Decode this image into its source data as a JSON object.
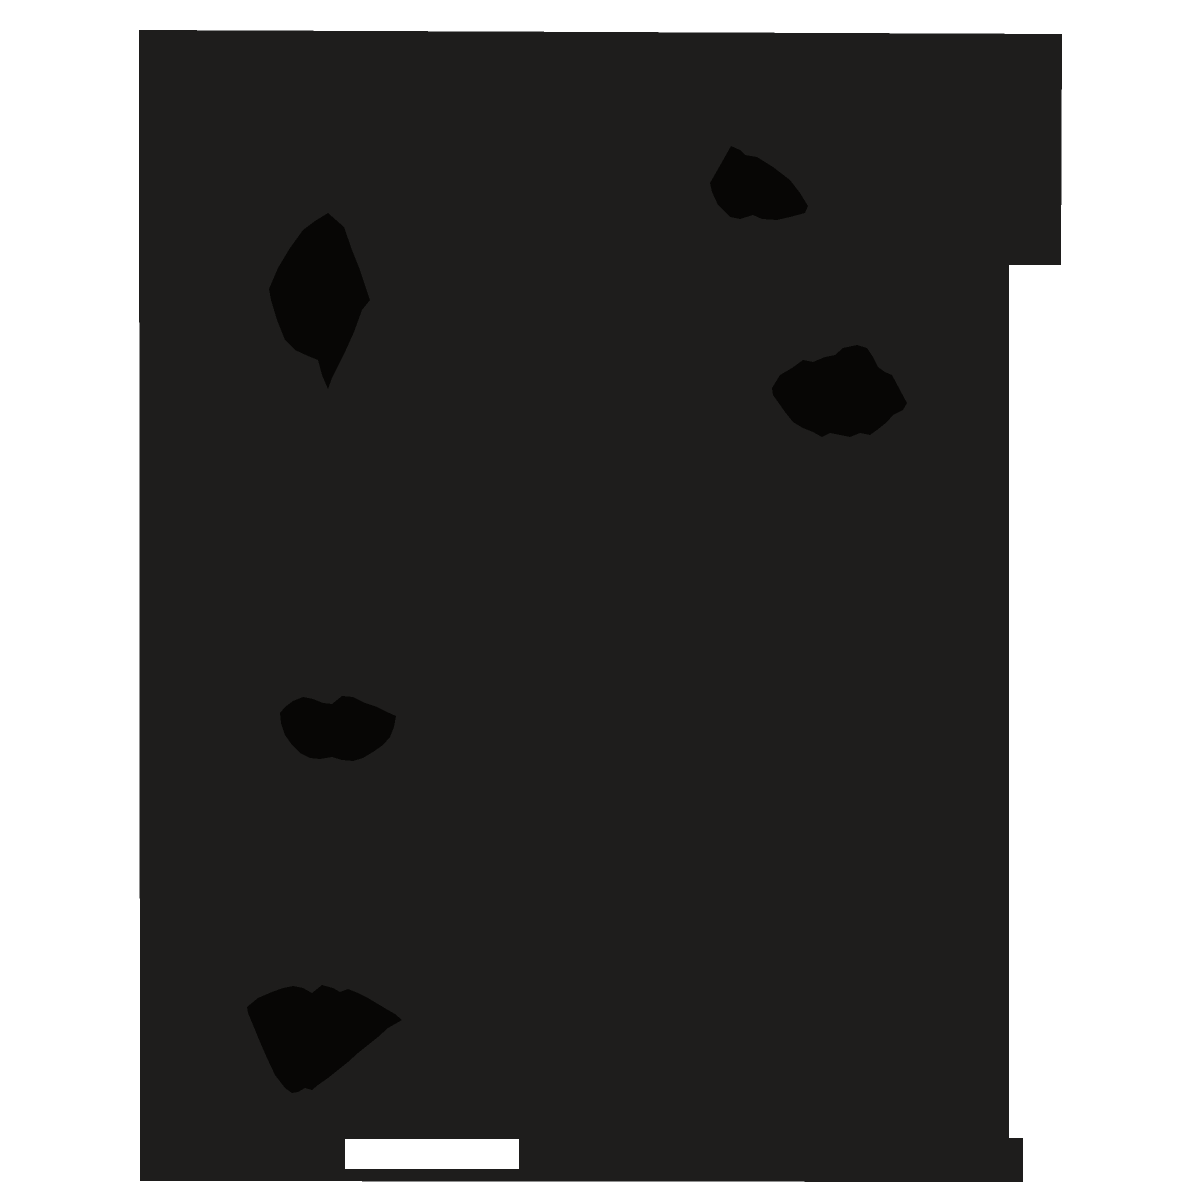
{
  "scene": {
    "description": "Scan of an almost entirely black page on a white backdrop; the dark page has slightly irregular stepped edges, five solid black ink blots, and one small white rectangular cutout near the bottom left",
    "colors": {
      "backdrop_white": "#ffffff",
      "page_dark": "#1e1d1c",
      "ink_black": "#070605"
    },
    "page_region": {
      "name": "dark-page-region",
      "points": [
        [
          139,
          30
        ],
        [
          1062,
          34
        ],
        [
          1061,
          265
        ],
        [
          1009,
          265
        ],
        [
          1009,
          1138
        ],
        [
          1023,
          1138
        ],
        [
          1023,
          1182
        ],
        [
          140,
          1181
        ]
      ]
    },
    "cutout": {
      "name": "white-cutout-rect",
      "x": 345,
      "y": 1139,
      "width": 174,
      "height": 30,
      "color": "#ffffff"
    },
    "blots": [
      {
        "name": "ink-blot-upper-left-diamond",
        "points": [
          [
            328,
            213
          ],
          [
            344,
            227
          ],
          [
            352,
            250
          ],
          [
            360,
            270
          ],
          [
            370,
            300
          ],
          [
            362,
            310
          ],
          [
            354,
            332
          ],
          [
            345,
            352
          ],
          [
            337,
            368
          ],
          [
            332,
            378
          ],
          [
            328,
            389
          ],
          [
            322,
            375
          ],
          [
            318,
            360
          ],
          [
            308,
            356
          ],
          [
            295,
            350
          ],
          [
            285,
            340
          ],
          [
            277,
            320
          ],
          [
            271,
            300
          ],
          [
            269,
            289
          ],
          [
            278,
            268
          ],
          [
            290,
            248
          ],
          [
            303,
            230
          ],
          [
            315,
            221
          ]
        ]
      },
      {
        "name": "ink-blot-top-right",
        "points": [
          [
            710,
            183
          ],
          [
            722,
            162
          ],
          [
            731,
            146
          ],
          [
            740,
            150
          ],
          [
            745,
            155
          ],
          [
            757,
            157
          ],
          [
            773,
            167
          ],
          [
            790,
            180
          ],
          [
            800,
            193
          ],
          [
            808,
            206
          ],
          [
            805,
            213
          ],
          [
            790,
            217
          ],
          [
            777,
            220
          ],
          [
            762,
            219
          ],
          [
            753,
            215
          ],
          [
            740,
            219
          ],
          [
            730,
            217
          ],
          [
            718,
            205
          ],
          [
            712,
            192
          ]
        ]
      },
      {
        "name": "ink-blot-mid-right",
        "points": [
          [
            772,
            388
          ],
          [
            780,
            375
          ],
          [
            792,
            368
          ],
          [
            803,
            360
          ],
          [
            813,
            362
          ],
          [
            825,
            357
          ],
          [
            835,
            355
          ],
          [
            843,
            348
          ],
          [
            857,
            345
          ],
          [
            867,
            348
          ],
          [
            873,
            357
          ],
          [
            878,
            367
          ],
          [
            885,
            372
          ],
          [
            892,
            375
          ],
          [
            900,
            390
          ],
          [
            907,
            403
          ],
          [
            903,
            410
          ],
          [
            893,
            415
          ],
          [
            887,
            422
          ],
          [
            877,
            430
          ],
          [
            870,
            435
          ],
          [
            860,
            433
          ],
          [
            850,
            437
          ],
          [
            840,
            435
          ],
          [
            830,
            433
          ],
          [
            822,
            437
          ],
          [
            813,
            432
          ],
          [
            803,
            428
          ],
          [
            793,
            422
          ],
          [
            785,
            412
          ],
          [
            778,
            402
          ],
          [
            773,
            395
          ]
        ]
      },
      {
        "name": "ink-blot-middle-left",
        "points": [
          [
            280,
            713
          ],
          [
            285,
            707
          ],
          [
            293,
            701
          ],
          [
            303,
            697
          ],
          [
            313,
            699
          ],
          [
            323,
            703
          ],
          [
            332,
            704
          ],
          [
            342,
            696
          ],
          [
            353,
            697
          ],
          [
            365,
            703
          ],
          [
            377,
            707
          ],
          [
            387,
            712
          ],
          [
            396,
            716
          ],
          [
            394,
            727
          ],
          [
            390,
            737
          ],
          [
            383,
            745
          ],
          [
            373,
            752
          ],
          [
            363,
            758
          ],
          [
            353,
            761
          ],
          [
            342,
            760
          ],
          [
            332,
            757
          ],
          [
            320,
            759
          ],
          [
            310,
            758
          ],
          [
            300,
            753
          ],
          [
            292,
            745
          ],
          [
            285,
            735
          ],
          [
            281,
            723
          ]
        ]
      },
      {
        "name": "ink-blot-lower-left",
        "points": [
          [
            247,
            1007
          ],
          [
            258,
            998
          ],
          [
            272,
            992
          ],
          [
            283,
            988
          ],
          [
            293,
            986
          ],
          [
            303,
            988
          ],
          [
            312,
            993
          ],
          [
            322,
            985
          ],
          [
            333,
            988
          ],
          [
            340,
            992
          ],
          [
            348,
            989
          ],
          [
            358,
            993
          ],
          [
            368,
            998
          ],
          [
            378,
            1004
          ],
          [
            388,
            1010
          ],
          [
            395,
            1014
          ],
          [
            402,
            1020
          ],
          [
            388,
            1028
          ],
          [
            378,
            1037
          ],
          [
            368,
            1045
          ],
          [
            358,
            1053
          ],
          [
            348,
            1062
          ],
          [
            338,
            1070
          ],
          [
            328,
            1078
          ],
          [
            318,
            1085
          ],
          [
            312,
            1090
          ],
          [
            305,
            1088
          ],
          [
            298,
            1092
          ],
          [
            292,
            1093
          ],
          [
            285,
            1088
          ],
          [
            275,
            1075
          ],
          [
            267,
            1058
          ],
          [
            260,
            1042
          ],
          [
            253,
            1025
          ],
          [
            248,
            1013
          ]
        ]
      }
    ]
  }
}
